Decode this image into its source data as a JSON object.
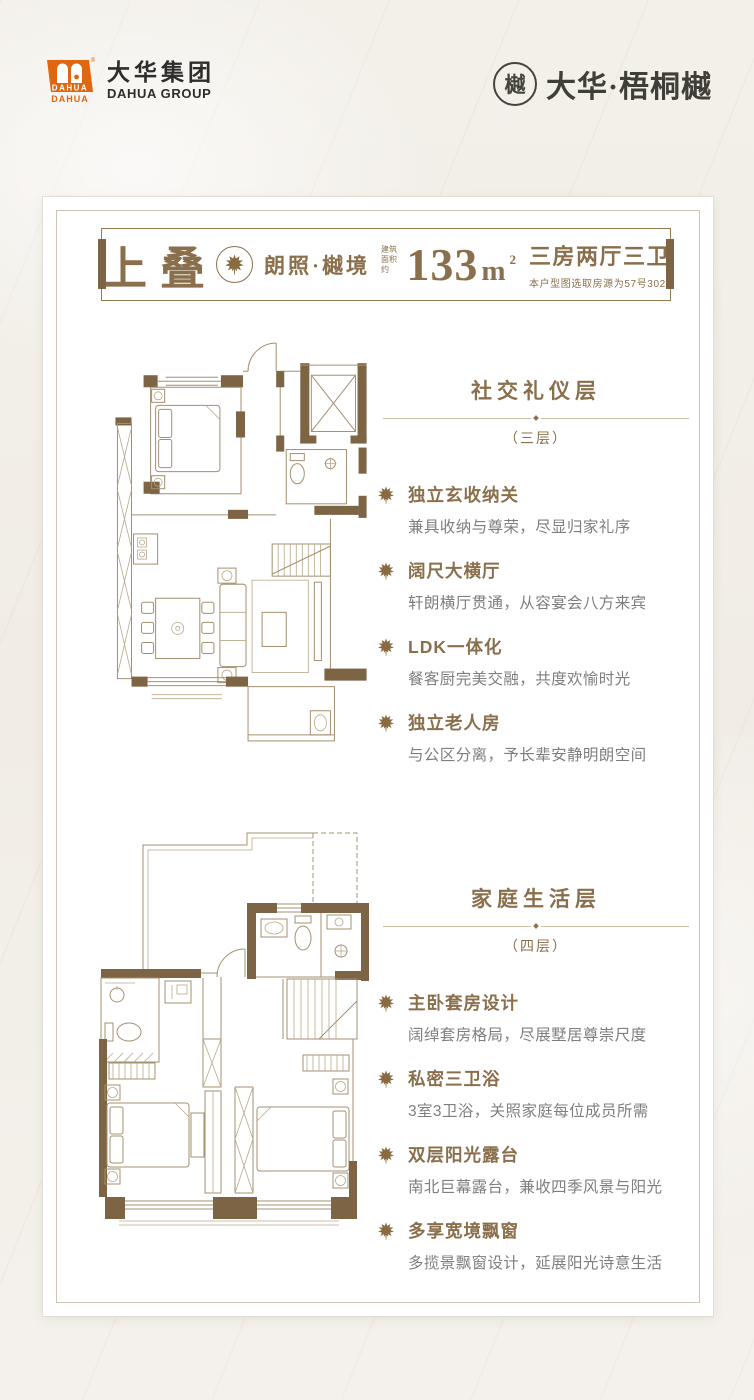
{
  "header": {
    "dahua_logo": {
      "mark_text": "DAHUA",
      "reg_mark": "®",
      "name_cn": "大华集团",
      "name_en": "DAHUA GROUP"
    },
    "project_logo": {
      "seal_char": "樾",
      "name": "大华·梧桐樾"
    }
  },
  "banner": {
    "product_type": "上叠",
    "series_name": "朗照·樾境",
    "area_prefix_line1": "建筑",
    "area_prefix_line2": "面积约",
    "area_value": "133",
    "area_unit": "m",
    "area_sup": "2",
    "layout_label": "三房两厅三卫",
    "source_note": "本户型图选取房源为57号302"
  },
  "sections": [
    {
      "title": "社交礼仪层",
      "floor": "（三层）",
      "features": [
        {
          "title": "独立玄收纳关",
          "desc": "兼具收纳与尊荣，尽显归家礼序"
        },
        {
          "title": "阔尺大横厅",
          "desc": "轩朗横厅贯通，从容宴会八方来宾"
        },
        {
          "title": "LDK一体化",
          "desc": "餐客厨完美交融，共度欢愉时光"
        },
        {
          "title": "独立老人房",
          "desc": "与公区分离，予长辈安静明朗空间"
        }
      ]
    },
    {
      "title": "家庭生活层",
      "floor": "（四层）",
      "features": [
        {
          "title": "主卧套房设计",
          "desc": "阔绰套房格局，尽展墅居尊崇尺度"
        },
        {
          "title": "私密三卫浴",
          "desc": "3室3卫浴，关照家庭每位成员所需"
        },
        {
          "title": "双层阳光露台",
          "desc": "南北巨幕露台，兼收四季风景与阳光"
        },
        {
          "title": "多享宽境飘窗",
          "desc": "多揽景飘窗设计，延展阳光诗意生活"
        }
      ]
    }
  ],
  "colors": {
    "accent_brown": "#8a6f4c",
    "wall_brown": "#7d6444",
    "desc_gray": "#7e7e7e",
    "logo_orange": "#e0660f",
    "dark_text": "#2e2d2b",
    "card_bg": "#ffffff",
    "page_bg": "#f2efe9"
  }
}
